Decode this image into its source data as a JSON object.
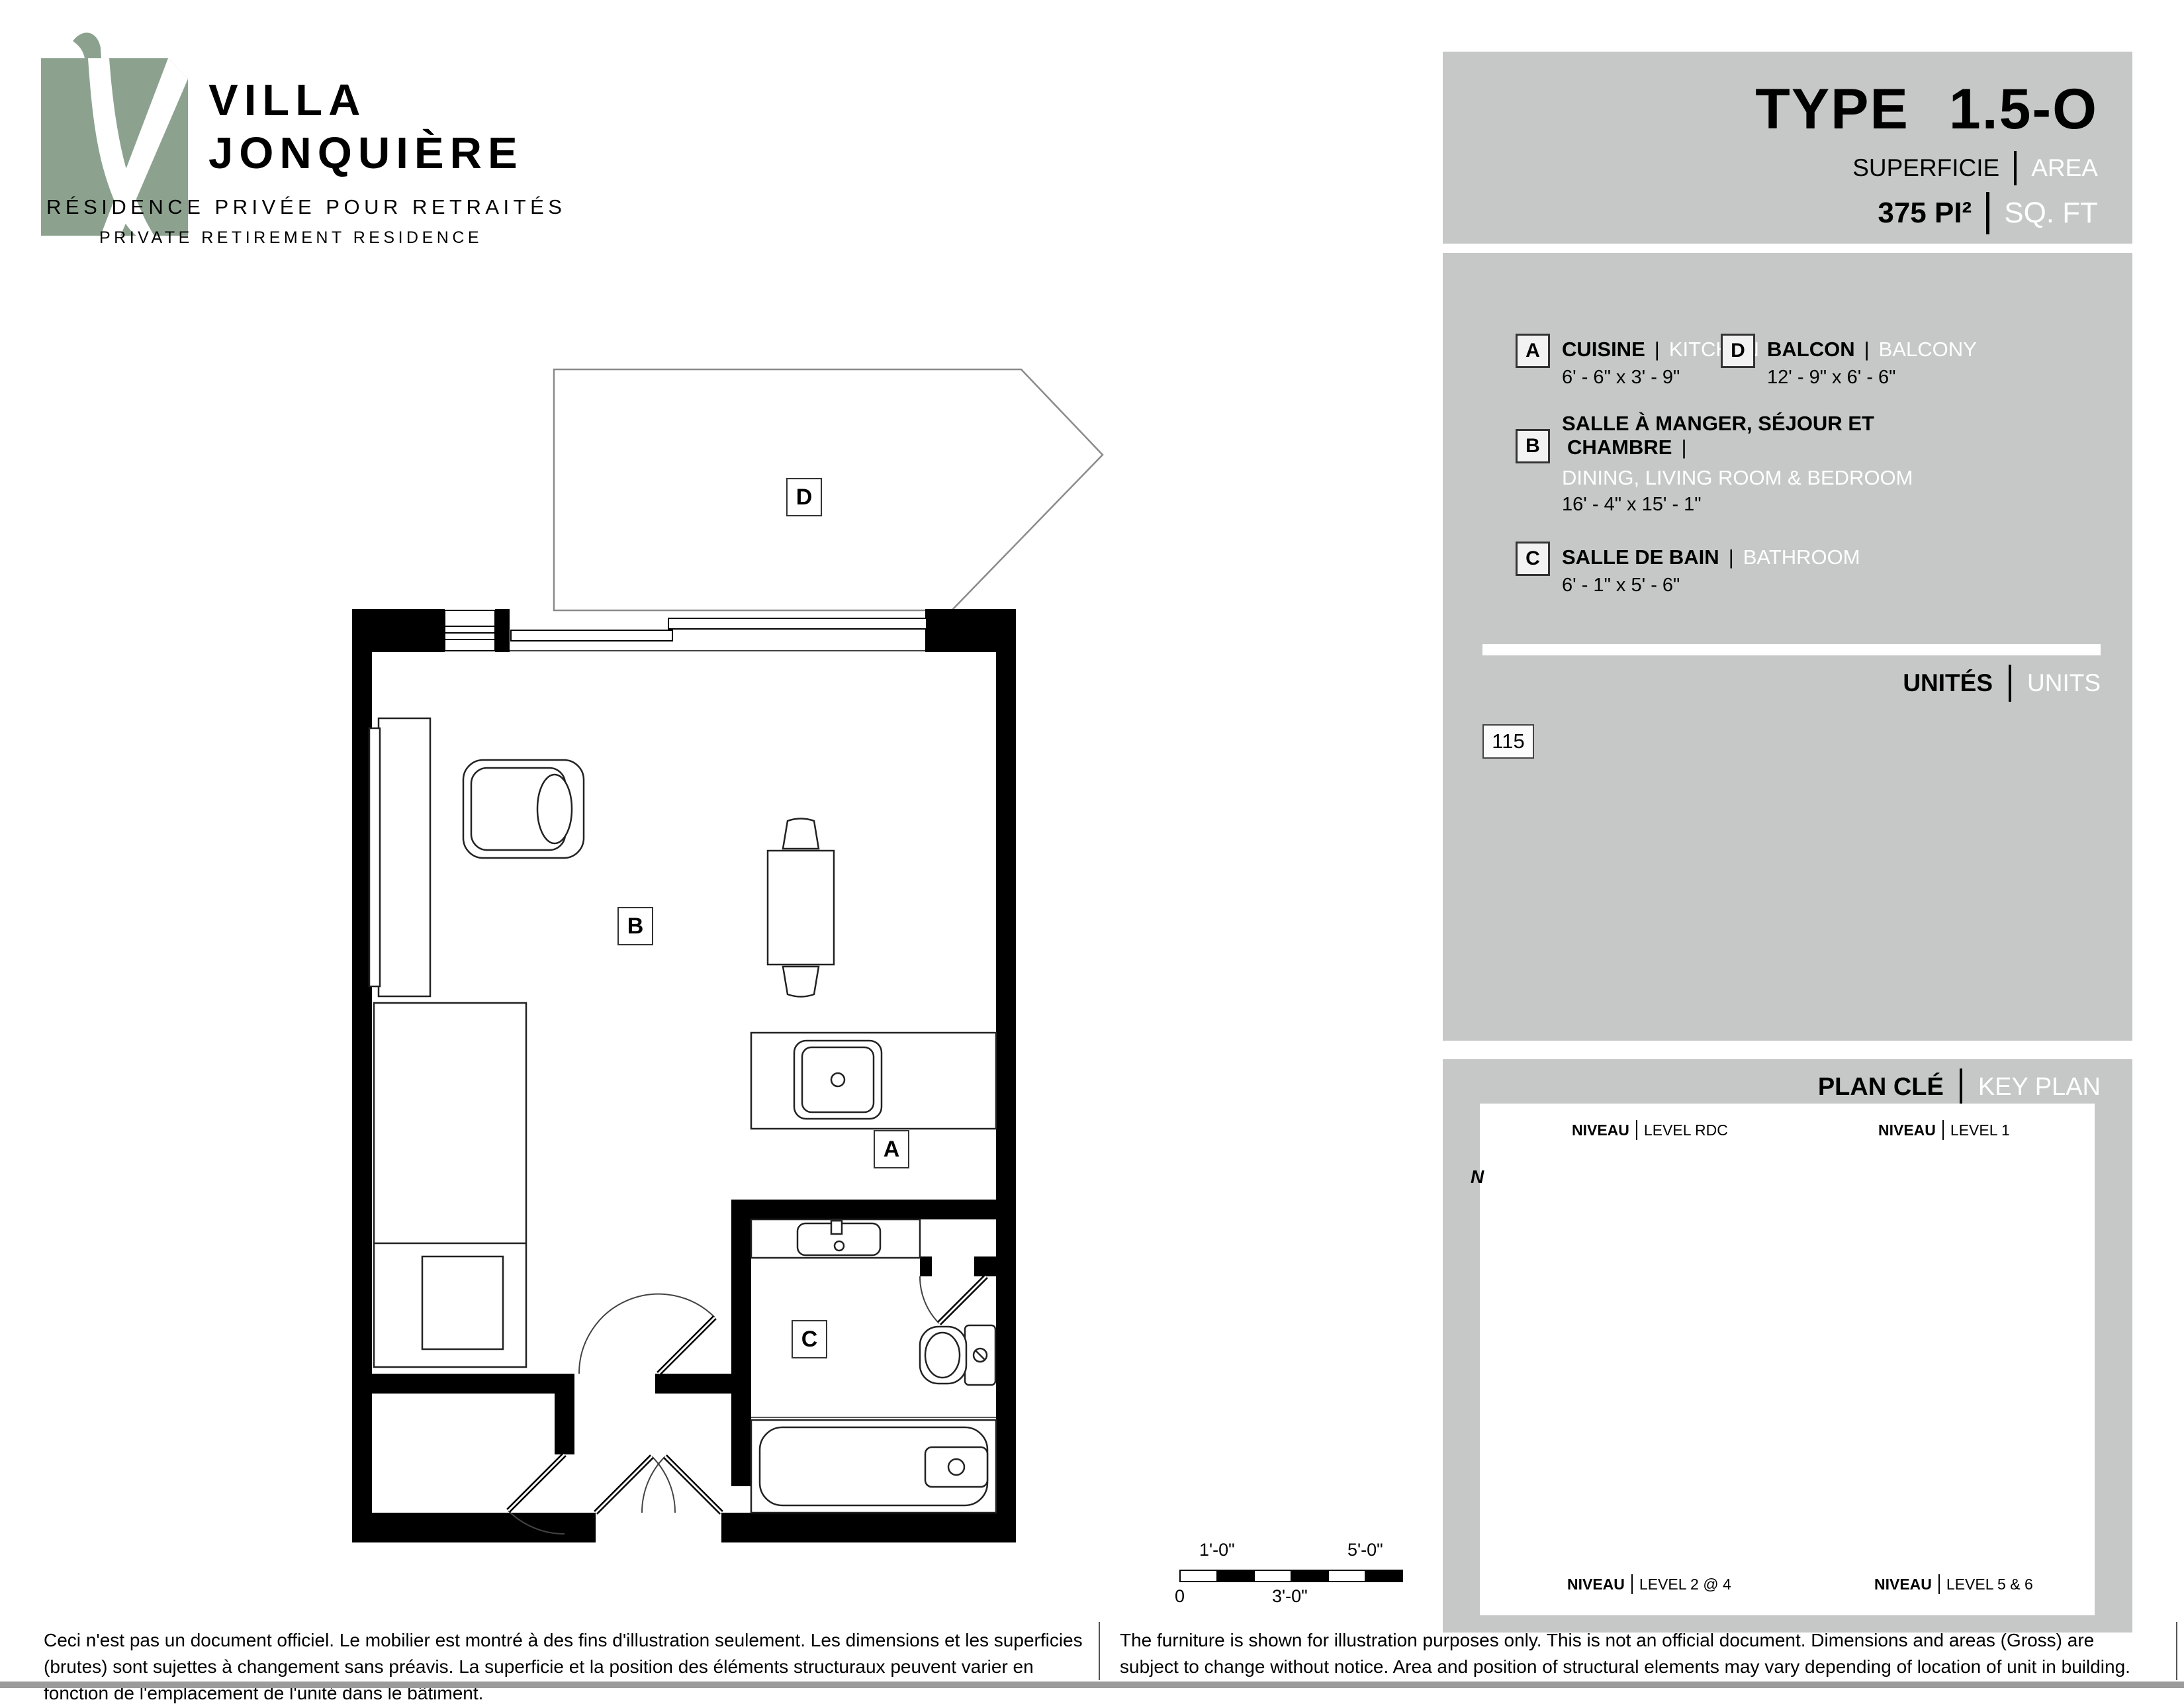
{
  "logo": {
    "name_line1": "VILLA",
    "name_line2": "JONQUIÈRE",
    "tagline_fr": "RÉSIDENCE PRIVÉE POUR RETRAITÉS",
    "tagline_en": "PRIVATE RETIREMENT RESIDENCE"
  },
  "title_panel": {
    "type_label": "TYPE",
    "type_value": "1.5-O",
    "area_label_fr": "SUPERFICIE",
    "area_label_en": "AREA",
    "area_value_fr": "375 PI²",
    "area_value_en": "SQ. FT"
  },
  "legend": {
    "items": [
      {
        "key": "A",
        "fr": "CUISINE",
        "en": "KITCHEN",
        "dims": "6' - 6\" x 3' - 9\""
      },
      {
        "key": "B",
        "fr_line1": "SALLE À MANGER, SÉJOUR ET",
        "fr_line2": "CHAMBRE",
        "en": "DINING, LIVING ROOM & BEDROOM",
        "dims": "16' - 4\" x 15' - 1\""
      },
      {
        "key": "C",
        "fr": "SALLE DE BAIN",
        "en": "BATHROOM",
        "dims": "6' - 1\" x 5' - 6\""
      },
      {
        "key": "D",
        "fr": "BALCON",
        "en": "BALCONY",
        "dims": "12' - 9\" x 6' - 6\""
      }
    ]
  },
  "units": {
    "label_fr": "UNITÉS",
    "label_en": "UNITS",
    "numbers": [
      "115"
    ]
  },
  "key_plan": {
    "title_fr": "PLAN CLÉ",
    "title_en": "KEY PLAN",
    "compass": "N",
    "levels": [
      {
        "label_fr": "NIVEAU",
        "label_en": "LEVEL RDC"
      },
      {
        "label_fr": "NIVEAU",
        "label_en": "LEVEL 1"
      },
      {
        "label_fr": "NIVEAU",
        "label_en": "LEVEL 2 @ 4"
      },
      {
        "label_fr": "NIVEAU",
        "label_en": "LEVEL 5 & 6"
      }
    ]
  },
  "scale_bar": {
    "zero": "0",
    "one_ft": "1'-0\"",
    "three_ft": "3'-0\"",
    "five_ft": "5'-0\""
  },
  "disclaimer": {
    "fr": "Ceci n'est pas un document officiel.  Le mobilier est montré à des fins d'illustration seulement.  Les dimensions et les superficies (brutes) sont sujettes à changement sans préavis. La superficie et la position des éléments structuraux peuvent varier en fonction de l'emplacement de l'unité dans le bâtiment.",
    "en": "The furniture is shown for illustration purposes only.  This is not an official document.  Dimensions and areas (Gross) are subject to change without notice.  Area and position of structural elements may vary depending of location of unit in building."
  },
  "colors": {
    "panel_gray": "#c6c8c7",
    "logo_green": "#8ca28f",
    "highlight_orange": "#bf5b21",
    "bottom_bar": "#9b9b9b"
  }
}
